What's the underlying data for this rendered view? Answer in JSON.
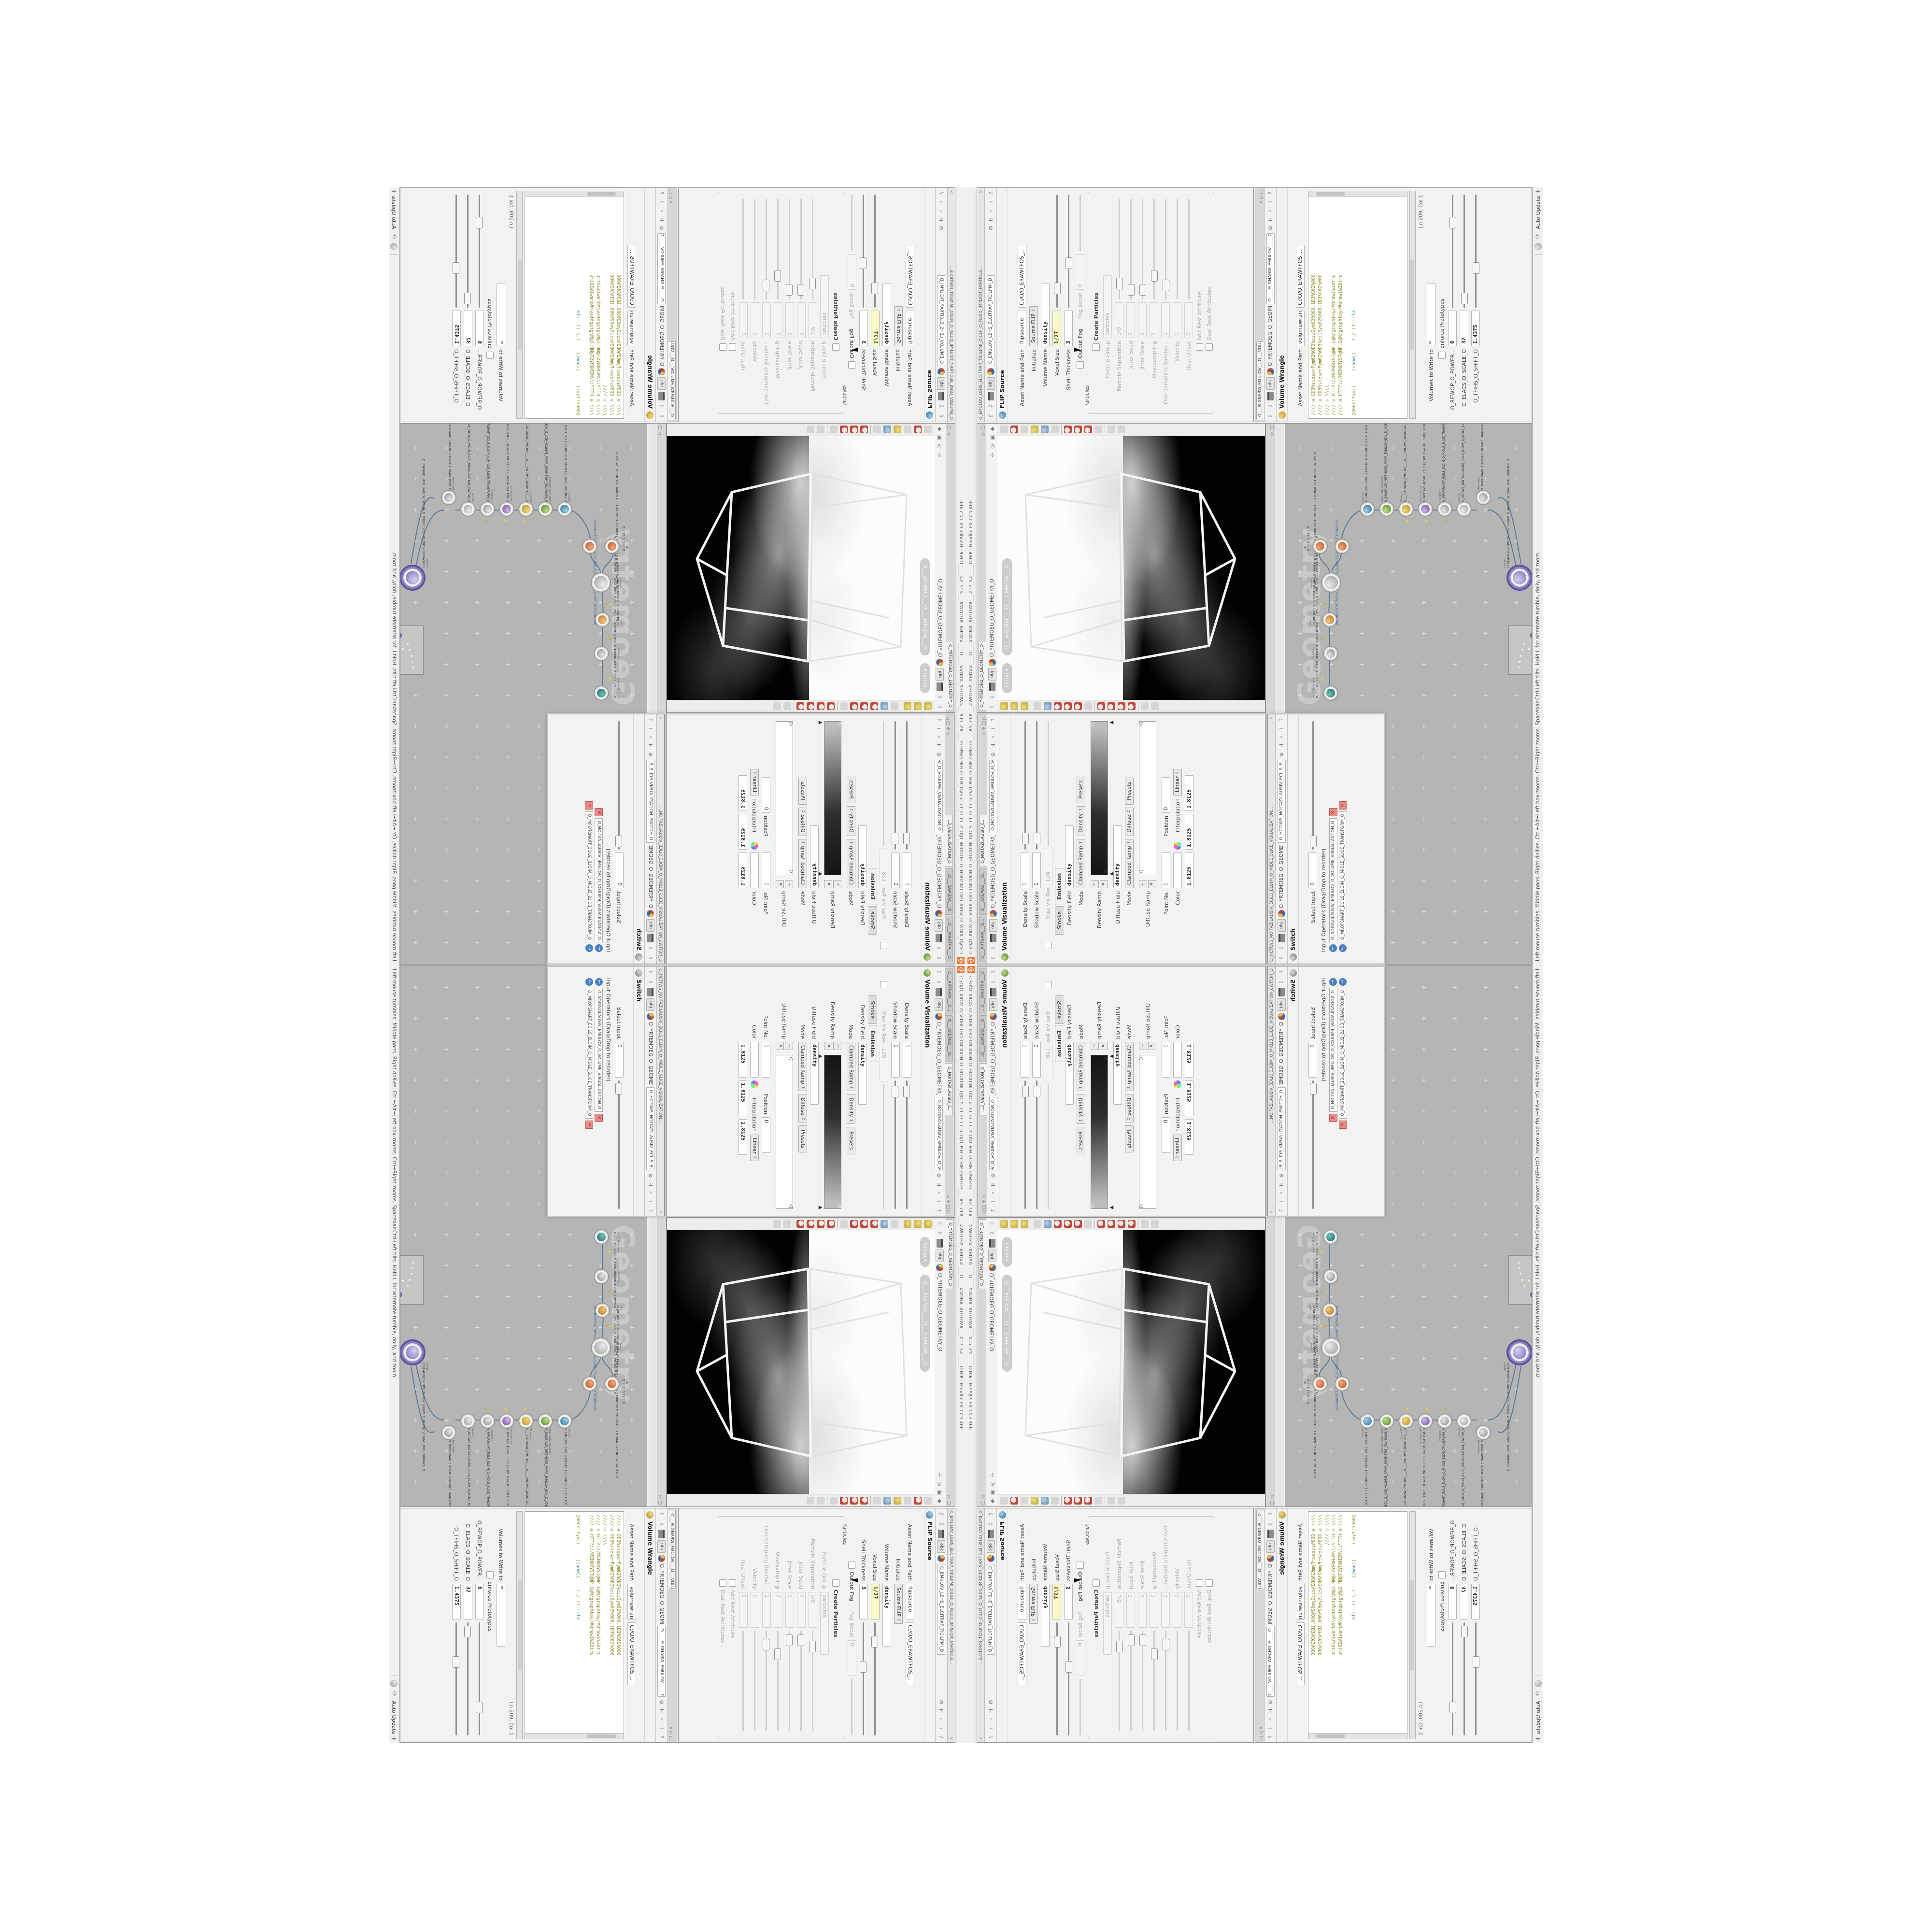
{
  "app": {
    "window_title": "C:/O/O_AIDIV_O_VIDIA_O/O_INIDUOH_O_HOUDINI_O/O_5_71_O_17_5_O/O_PIH_O_HIP_O/PIH.O____#5_71#___#WOLG#_#BDV#____O____#VDB#_#GLOW#___#17_5#_____O.HIP - Houdini FX 17.5.460",
    "status_message": "Left mouse tumbles. Middle pans. Right dollies. Ctrl+Alt+Left box-zooms. Ctrl+Right zooms. Spacebar-Ctrl-Left tilts. Hold L for alternate tumble, dolly, and zoom.",
    "auto_update": "Auto Update"
  },
  "icons": {
    "close": "×",
    "chevron": "▾",
    "pane_expand": "▷",
    "pane_max": "□",
    "pane_split": "✛",
    "up": "⇧",
    "down": "⇩",
    "gear": "⚙",
    "magnifier": "⌕",
    "houdini": "H",
    "info": "i",
    "help": "?",
    "plus": "+",
    "cross": "✕",
    "marker_left": "◁",
    "marker_up": "▲",
    "tri_left": "◀",
    "tri_right": "▶",
    "recycle": "⟳",
    "obj": "obj"
  },
  "breadcrumb": {
    "net": "obj",
    "geometry": "O_YRTEMOEG_O_GEOMETRY_O"
  },
  "volvis": {
    "tab1": "O___ARTNAM___O...",
    "tab2": "O___AREMAC___O...",
    "tab3": "O_NOITAZILAUSIV_E...",
    "node_field": "O_NOITAZILAUSIV_EMULOV_O_VO",
    "title": "Volume Visualization",
    "rows": {
      "density_scale": {
        "l": "Density Scale",
        "v": "1"
      },
      "shadow_scale": {
        "l": "Shadow Scale",
        "v": "1"
      },
      "max_vis_res": {
        "l": "Max Vis Res",
        "v": "128"
      }
    },
    "tab_smoke": "Smoke",
    "tab_emission": "Emission",
    "density_field": {
      "l": "Density Field",
      "v": "density"
    },
    "mode": {
      "l": "Mode",
      "v": "Clamped Ramp",
      "v2": "Density",
      "btn": "Presets"
    },
    "density_ramp_label": "Density Ramp",
    "diffuse_field": {
      "l": "Diffuse Field",
      "v": "density"
    },
    "mode2": {
      "l": "Mode",
      "v": "Clamped Ramp",
      "v2": "Diffuse",
      "btn": "Presets"
    },
    "diffuse_ramp_label": "Diffuse Ramp",
    "point_no": {
      "l": "Point No.",
      "v": "1"
    },
    "position": {
      "l": "Position",
      "v": "0"
    },
    "color": {
      "l": "Color"
    },
    "interpolation": {
      "l": "Interpolation",
      "v": "Linear"
    },
    "range_vals": [
      "1.8125",
      "1.8125",
      "1.8125"
    ]
  },
  "switchwin": {
    "title": "O_HCTIWS_NOITAZILAUSIV_ECILS_ELDIM_O_MIDLE_SLICE_VISUALIZATION...",
    "node_field": "O_HCTIWS_NOITAZILAUSIV_ECILS_ELDIM_O_",
    "name": "Switch",
    "select_input": {
      "l": "Select Input",
      "v": "0"
    },
    "input_ops_label": "Input Operators (Drag/Drop to reorder)",
    "input1": "O_NOITAZILAUSIV_EMULOV_O_VOLUME_VISUALIZATION_O",
    "input2": "O_MROFSNART_ECILS_ELDIM_O_MIDLE_SLICE_TRANSFORM_O"
  },
  "viewport": {
    "tab": "O_YRTEMOEG_O_GEOMETRY_O",
    "pill_ortho": "Ortho ▾",
    "pill_camera": "O___AREMAC___O___CAMERA___O"
  },
  "network": {
    "tab": "O_YRTEMOEG_O_GEOMETRY_O",
    "path": "/obj/O_YRTEMOEG_O_GEOMETRY_O",
    "watermark": "Geometry",
    "nodes": [
      {
        "t": "an_CubeSphere",
        "n": "O_EREHPS_EBUC_D_CUBE_SPHERE_O"
      },
      {
        "t": "PolyWire",
        "n": "O_EMARFERIW_NOGYLOP_EREHPS_EBUC_D_CUBE_SPHERE_POLYGON_WIREFRAME_O"
      },
      {
        "t": "File",
        "n": "O_JBO.MD3.PET5.TRP5LS_D_6AN.US.X.B.D"
      },
      {
        "t": "Switch",
        "n": "O_HCTIWS_YRTEMOEG_LANRETXE_LANRETNI_O_INTERNAL_EXTERNAL_GEOMETRY_SWITCH_O"
      },
      {
        "t": "Clip",
        "n": "O_PILC_O_CLIP_O"
      },
      {
        "t": "Source",
        "n": "O_EMULOV_LEHS_ELCITRAP_TICILPMI_DIULF_O_FLUID_IMPLICIT_PARTICLE_SHEL_VOLUME_O"
      },
      {
        "t": "VDB from Polygons",
        "n": "O_SNOGILOP_YRTEMOEG_MORF_EMULOV_BDV_D_VDB_VOLUME_FROM_GEOMETRY_POLYGONS_O"
      },
      {
        "t": "Wrangle",
        "n": "O___ELGNARW_EMULOV____O____VOLUME_WRANGLE___O"
      },
      {
        "t": "VolumeSlice",
        "n": "O_NOITAZILAUSIV_ECILS_ELDIM_O_MIDLE_SLICE_VISUALIZATION_O"
      },
      {
        "t": "Transform",
        "n": "O_MROFSNART_ECILS_ELDIM_O_MIDLE_SLICE_TRANSFORM_O"
      },
      {
        "t": "Switch",
        "n": "O_HCTIWS_NOITAZILAUSIV_ECILS_ELDIM_O_MIDLE_SLICE_VISUALIZATION_SWITCH_O"
      },
      {
        "t": "Transform",
        "n": "O_MROFSNART_TLUSER_O_RESULT_TRANSFORM_O"
      },
      {
        "t": "Merge",
        "n": "O_ECAFRUS_HTIW_EMULOV_EGREM_O_MERGE_VOLUME_WITH_SURFACE_O"
      }
    ],
    "file_sub": "JBO.MD3.PET5.TRP.5LS_D_50U%PEG_O_GEM.S3_D.SLD4PT.STEP.3DM.OBJ"
  },
  "flip": {
    "title": "O_EMULOV_LEHS_ELCITRAP_TICILPMI_DIULF_O_FLUID_IMPLICIT_PARTICLE...",
    "node_field": "O_EMULOV_LEHS_ELCITRAP_TICILPMI_D",
    "name": "FLIP Source",
    "asset": {
      "l": "Asset Name and Path",
      "v": "flipsource",
      "v2": "C:/O/O_ERAWTFOS_..."
    },
    "initialize": {
      "l": "Initialize",
      "v": "Source FLIP"
    },
    "volume_name": {
      "l": "Volume Name",
      "v": "density"
    },
    "voxel_size": {
      "l": "Voxel Size",
      "v": "1/27"
    },
    "shell_thickness": {
      "l": "Shell Thickness",
      "v": "3"
    },
    "output_fog": "Output Fog",
    "fog_boost": {
      "l": "Fog Boost",
      "v": "0"
    },
    "grp": "Particles",
    "create_particles": "Create Particles",
    "particle_group": {
      "l": "Particle Group",
      "v": "particles"
    },
    "particle_sep": {
      "l": "Particle Separation",
      "v": "1/9"
    },
    "jitter_seed": {
      "l": "Jitter Seed",
      "v": "0"
    },
    "jitter_scale": {
      "l": "Jitter Scale",
      "v": "0"
    },
    "oversampling": {
      "l": "Oversampling",
      "v": "2"
    },
    "oversampling_bw": {
      "l": "Oversampling Bandwi...",
      "v": "1"
    },
    "velocity": {
      "l": "Velocity",
      "v": "0"
    },
    "rest_offset": {
      "l": "Rest Offset",
      "v": "0"
    },
    "add_rest": "Add Rest Attribute",
    "dual_rest": "Dual Rest Attributes"
  },
  "wrangle": {
    "tab": "O___ELGNARW_EMULOV___O___VOLUME_WRANGL...",
    "node_field": "O____ELGNARW_EMULOV_____O_____VO",
    "name": "Volume Wrangle",
    "asset": {
      "l": "Asset Name and Path",
      "v": "volumewrangle",
      "v2": "C:/O/O_ERAWTFOS_..."
    },
    "code": [
      "//// ◎ 0D3%steserPym62%0D3%eziSym62%000.1D3%C62%000.",
      "//// ◎ 0D3%steserPym62%0D3%eziSym62%000.1D3%C62%000.",
      "//// ◎ \\\\\\\\",
      "//// ◎ HTTP://MEMORYST@MP.C@M/graphtoy/#draw1%3Dtru",
      "//// ◎ HTTP://MEMORYST@MP.C@M/graphtoy/#draw1%3Dtru"
    ],
    "code_last": {
      "a": "@density=((",
      "b": "((",
      "kw1": "pow",
      "c": "((",
      "d": "1./ (1.-",
      "kw2": "cla"
    },
    "lnstat": "Ln 209, Col 1",
    "volumes_to": {
      "l": "Volumes to Write to",
      "v": "*"
    },
    "enforce": "Enforce Prototypes",
    "power": {
      "l": "O_REWOP_O_POWER...",
      "v": "6"
    },
    "scale": {
      "l": "O_ELACS_O_SCALE_O",
      "v": "32"
    },
    "shift": {
      "l": "O_TFIHS_O_SHIFT_O",
      "v": "1.4375"
    }
  }
}
